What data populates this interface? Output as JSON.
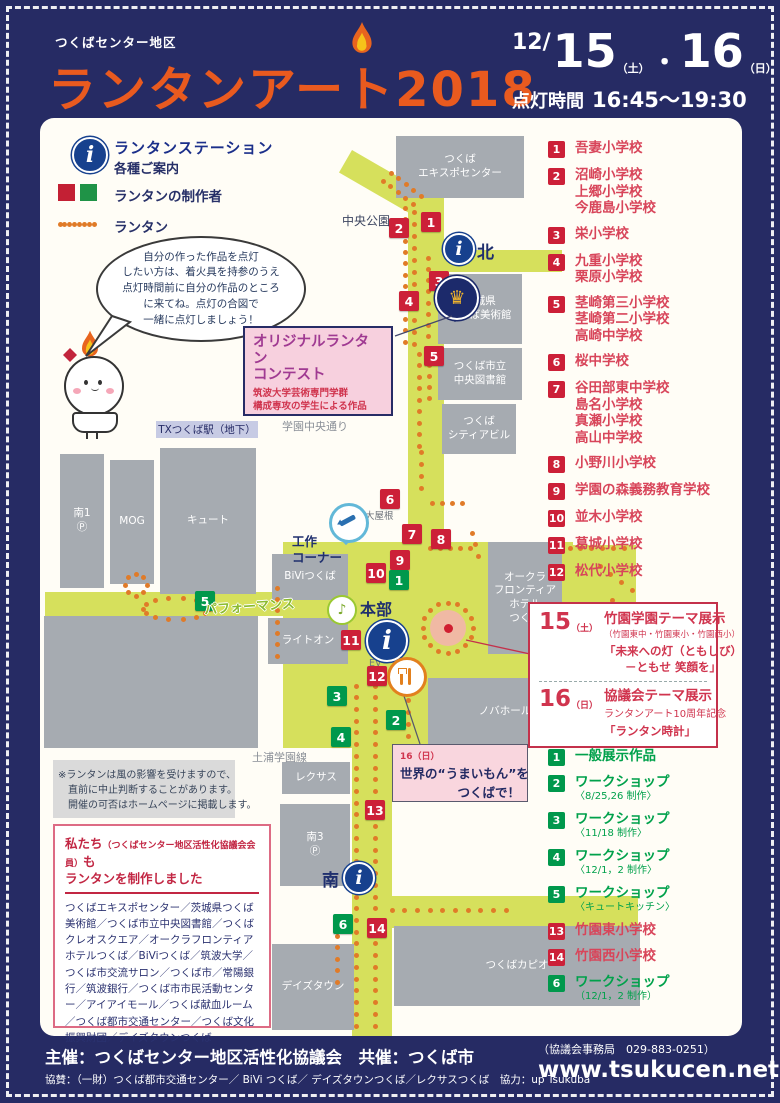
{
  "header": {
    "area": "つくばセンター地区",
    "title": "ランタンアート",
    "year": "2018",
    "date_month": "12/",
    "day1": "15",
    "day1_wk": "（土）",
    "dot": "・",
    "day2": "16",
    "day2_wk": "（日）",
    "time_label": "点灯時間",
    "time": "16:45～19:30"
  },
  "legend": {
    "station_title": "ランタンステーション",
    "station_sub": "各種ご案内",
    "makers": "ランタンの制作者",
    "lantern": "ランタン"
  },
  "bubble": {
    "lines": [
      "自分の作った作品を点灯",
      "したい方は、着火具を持参のうえ",
      "点灯時間前に自分の作品のところ",
      "に来てね。点灯の合図で",
      "一緒に点灯しましょう！"
    ]
  },
  "contest_box": {
    "title1": "オリジナルランタン",
    "title2": "コンテスト",
    "sub1": "筑波大学芸術専門学群",
    "sub2": "構成専攻の学生による作品"
  },
  "school_list": [
    {
      "num": "1",
      "names": [
        "吾妻小学校"
      ]
    },
    {
      "num": "2",
      "names": [
        "沼崎小学校",
        "上郷小学校",
        "今鹿島小学校"
      ]
    },
    {
      "num": "3",
      "names": [
        "栄小学校"
      ]
    },
    {
      "num": "4",
      "names": [
        "九重小学校",
        "栗原小学校"
      ]
    },
    {
      "num": "5",
      "names": [
        "茎崎第三小学校",
        "茎崎第二小学校",
        "高崎中学校"
      ]
    },
    {
      "num": "6",
      "names": [
        "桜中学校"
      ]
    },
    {
      "num": "7",
      "names": [
        "谷田部東中学校",
        "島名小学校",
        "真瀬小学校",
        "高山中学校"
      ]
    },
    {
      "num": "8",
      "names": [
        "小野川小学校"
      ]
    },
    {
      "num": "9",
      "names": [
        "学園の森義務教育学校"
      ]
    },
    {
      "num": "10",
      "names": [
        "並木小学校"
      ]
    },
    {
      "num": "11",
      "names": [
        "葛城小学校"
      ]
    },
    {
      "num": "12",
      "names": [
        "松代小学校"
      ]
    }
  ],
  "theme_box": {
    "d15_num": "15",
    "d15_wk": "（土）",
    "d15_title": "竹園学園テーマ展示",
    "d15_sub": "（竹園東中・竹園東小・竹園西小）",
    "d15_q1": "「未来への灯（ともしび）",
    "d15_q2": "－ともせ 笑顔を」",
    "d16_num": "16",
    "d16_wk": "（日）",
    "d16_title": "協議会テーマ展示",
    "d16_sub": "ランタンアート10周年記念",
    "d16_q": "「ランタン時計」"
  },
  "workshop_list": [
    {
      "num": "1",
      "color": "green",
      "label": "一般展示作品",
      "sub": ""
    },
    {
      "num": "2",
      "color": "green",
      "label": "ワークショップ",
      "sub": "〈8/25,26 制作〉"
    },
    {
      "num": "3",
      "color": "green",
      "label": "ワークショップ",
      "sub": "〈11/18 制作〉"
    },
    {
      "num": "4",
      "color": "green",
      "label": "ワークショップ",
      "sub": "〈12/1，2 制作〉"
    },
    {
      "num": "5",
      "color": "green",
      "label": "ワークショップ",
      "sub": "〈キュートキッチン〉"
    },
    {
      "num": "13",
      "color": "red",
      "label": "竹園東小学校",
      "sub": ""
    },
    {
      "num": "14",
      "color": "red",
      "label": "竹園西小学校",
      "sub": ""
    },
    {
      "num": "6",
      "color": "green",
      "label": "ワークショップ",
      "sub": "（12/1，2 制作）"
    }
  ],
  "umaimon_box": {
    "date": "16（日）",
    "line1": "世界の“うまいもん”を",
    "line2": "つくばで！"
  },
  "note_lines": [
    "※ランタンは風の影響を受けますので、",
    "　直前に中止判断することがあります。",
    "　開催の可否はホームページに掲載します。"
  ],
  "makers_box": {
    "t1": "私たち",
    "t1b": "（つくばセンター地区活性化協議会会員）",
    "t1c": "も",
    "t2": "ランタンを制作しました",
    "body": "つくばエキスポセンター／茨城県つくば美術館／つくば市立中央図書館／つくばクレオスクエア／オークラフロンティアホテルつくば／BiViつくば／筑波大学／つくば市交流サロン／つくば市／常陽銀行／筑波銀行／つくば市市民活動センター／アイアイモール／つくば献血ルーム／つくば都市交通センター／つくば文化振興財団／デイズタウンつくば"
  },
  "footer": {
    "line1": "主催：つくばセンター地区活性化協議会　共催：つくば市",
    "line2": "協賛：（一財）つくば都市交通センター／ BiVi つくば／ デイズタウンつくば／レクサスつくば　協力：up Tsukuba",
    "office": "（協議会事務局　029-883-0251）",
    "url": "www.tsukucen.net"
  },
  "map": {
    "tx": "TXつくば駅（地下）",
    "north": "北",
    "south": "南",
    "hq": "本部",
    "craft": "工作\nコーナー",
    "perf": "パフォーマンス",
    "roads": [
      {
        "x": 352,
        "y": 150,
        "w": 100,
        "h": 26,
        "rot": 30
      },
      {
        "x": 408,
        "y": 188,
        "w": 36,
        "h": 360
      },
      {
        "x": 430,
        "y": 250,
        "w": 132,
        "h": 22
      },
      {
        "x": 283,
        "y": 542,
        "w": 290,
        "h": 206
      },
      {
        "x": 560,
        "y": 545,
        "w": 76,
        "h": 96
      },
      {
        "x": 45,
        "y": 592,
        "w": 240,
        "h": 24
      },
      {
        "x": 352,
        "y": 700,
        "w": 40,
        "h": 336
      },
      {
        "x": 392,
        "y": 896,
        "w": 246,
        "h": 32
      }
    ],
    "buildings": [
      {
        "l": "つくば\nエキスポセンター",
        "x": 396,
        "y": 136,
        "w": 128,
        "h": 62
      },
      {
        "l": "茨城県\nつくば美術館",
        "x": 438,
        "y": 274,
        "w": 84,
        "h": 70
      },
      {
        "l": "つくば市立\n中央図書館",
        "x": 438,
        "y": 348,
        "w": 84,
        "h": 52
      },
      {
        "l": "つくば\nシティアビル",
        "x": 442,
        "y": 404,
        "w": 74,
        "h": 50
      },
      {
        "l": "南1\nⓅ",
        "x": 60,
        "y": 454,
        "w": 44,
        "h": 134
      },
      {
        "l": "MOG",
        "x": 110,
        "y": 460,
        "w": 44,
        "h": 124
      },
      {
        "l": "キュート",
        "x": 160,
        "y": 448,
        "w": 96,
        "h": 146
      },
      {
        "l": "BiViつくば",
        "x": 272,
        "y": 554,
        "w": 76,
        "h": 46
      },
      {
        "l": "ライトオン",
        "x": 268,
        "y": 618,
        "w": 80,
        "h": 46
      },
      {
        "l": "オークラ\nフロンティア\nホテル\nつくば",
        "x": 488,
        "y": 542,
        "w": 74,
        "h": 112
      },
      {
        "l": "ノバホール",
        "x": 428,
        "y": 678,
        "w": 154,
        "h": 68
      },
      {
        "l": "",
        "x": 44,
        "y": 616,
        "w": 214,
        "h": 132
      },
      {
        "l": "",
        "x": 53,
        "y": 760,
        "w": 182,
        "h": 58,
        "light": true
      },
      {
        "l": "レクサス",
        "x": 282,
        "y": 762,
        "w": 68,
        "h": 32
      },
      {
        "l": "南3\nⓅ",
        "x": 280,
        "y": 804,
        "w": 70,
        "h": 82
      },
      {
        "l": "デイズタウン",
        "x": 272,
        "y": 944,
        "w": 82,
        "h": 86
      },
      {
        "l": "つくばカピオ",
        "x": 394,
        "y": 926,
        "w": 246,
        "h": 80
      }
    ],
    "labels": [
      {
        "t": "中央公園",
        "x": 342,
        "y": 212,
        "c": "lbl-navy"
      },
      {
        "t": "学園中央通り",
        "x": 282,
        "y": 418,
        "c": "lbl-gray"
      },
      {
        "t": "土浦学園線",
        "x": 252,
        "y": 749,
        "c": "lbl-gray"
      },
      {
        "t": "大屋根",
        "x": 365,
        "y": 508,
        "c": "lbl-gray-s"
      },
      {
        "t": "EV",
        "x": 350,
        "y": 532,
        "c": "lbl-gray-s"
      },
      {
        "t": "EV",
        "x": 369,
        "y": 658,
        "c": "lbl-gray-s"
      }
    ],
    "markers": [
      {
        "n": "1",
        "c": "red",
        "x": 421,
        "y": 212
      },
      {
        "n": "2",
        "c": "red",
        "x": 389,
        "y": 218
      },
      {
        "n": "3",
        "c": "red",
        "x": 429,
        "y": 271
      },
      {
        "n": "4",
        "c": "red",
        "x": 399,
        "y": 291
      },
      {
        "n": "5",
        "c": "red",
        "x": 424,
        "y": 346
      },
      {
        "n": "6",
        "c": "red",
        "x": 380,
        "y": 489
      },
      {
        "n": "7",
        "c": "red",
        "x": 402,
        "y": 524
      },
      {
        "n": "8",
        "c": "red",
        "x": 431,
        "y": 529
      },
      {
        "n": "9",
        "c": "red",
        "x": 390,
        "y": 550
      },
      {
        "n": "10",
        "c": "red",
        "x": 366,
        "y": 563
      },
      {
        "n": "11",
        "c": "red",
        "x": 341,
        "y": 630
      },
      {
        "n": "12",
        "c": "red",
        "x": 367,
        "y": 666
      },
      {
        "n": "13",
        "c": "red",
        "x": 365,
        "y": 800
      },
      {
        "n": "14",
        "c": "red",
        "x": 367,
        "y": 918
      },
      {
        "n": "1",
        "c": "green",
        "x": 389,
        "y": 570
      },
      {
        "n": "2",
        "c": "green",
        "x": 386,
        "y": 710
      },
      {
        "n": "3",
        "c": "green",
        "x": 327,
        "y": 686
      },
      {
        "n": "4",
        "c": "green",
        "x": 331,
        "y": 727
      },
      {
        "n": "5",
        "c": "green",
        "x": 195,
        "y": 591
      },
      {
        "n": "6",
        "c": "green",
        "x": 333,
        "y": 914
      }
    ],
    "dots": [
      [
        60,
        224,
        94,
        224,
        8
      ],
      [
        391,
        173,
        421,
        196,
        5
      ],
      [
        383,
        181,
        413,
        204,
        5
      ],
      [
        405,
        208,
        405,
        342,
        13
      ],
      [
        414,
        212,
        414,
        344,
        12
      ],
      [
        428,
        258,
        428,
        348,
        9
      ],
      [
        419,
        354,
        419,
        446,
        9
      ],
      [
        429,
        354,
        429,
        398,
        5
      ],
      [
        421,
        452,
        421,
        488,
        4
      ],
      [
        432,
        503,
        462,
        503,
        4
      ],
      [
        430,
        548,
        470,
        548,
        5
      ],
      [
        472,
        533,
        478,
        556,
        3
      ],
      [
        570,
        548,
        624,
        548,
        6
      ],
      [
        600,
        566,
        632,
        590,
        4
      ],
      [
        612,
        600,
        612,
        636,
        4
      ],
      [
        277,
        588,
        277,
        656,
        7
      ],
      [
        356,
        686,
        356,
        1026,
        30
      ],
      [
        375,
        686,
        375,
        1026,
        30
      ],
      [
        392,
        910,
        506,
        910,
        10
      ],
      [
        337,
        936,
        337,
        982,
        5
      ],
      [
        408,
        700,
        408,
        736,
        4
      ]
    ],
    "rings": [
      [
        136,
        585,
        11,
        11,
        8
      ],
      [
        176,
        609,
        33,
        11,
        14
      ],
      [
        448,
        628,
        25,
        25,
        16
      ]
    ]
  },
  "colors": {
    "navy": "#262b64",
    "orange": "#e95a1f",
    "road": "#d6e05c",
    "marker_red": "#cc2038",
    "marker_green": "#00984c",
    "pink": "#f7d0de"
  }
}
